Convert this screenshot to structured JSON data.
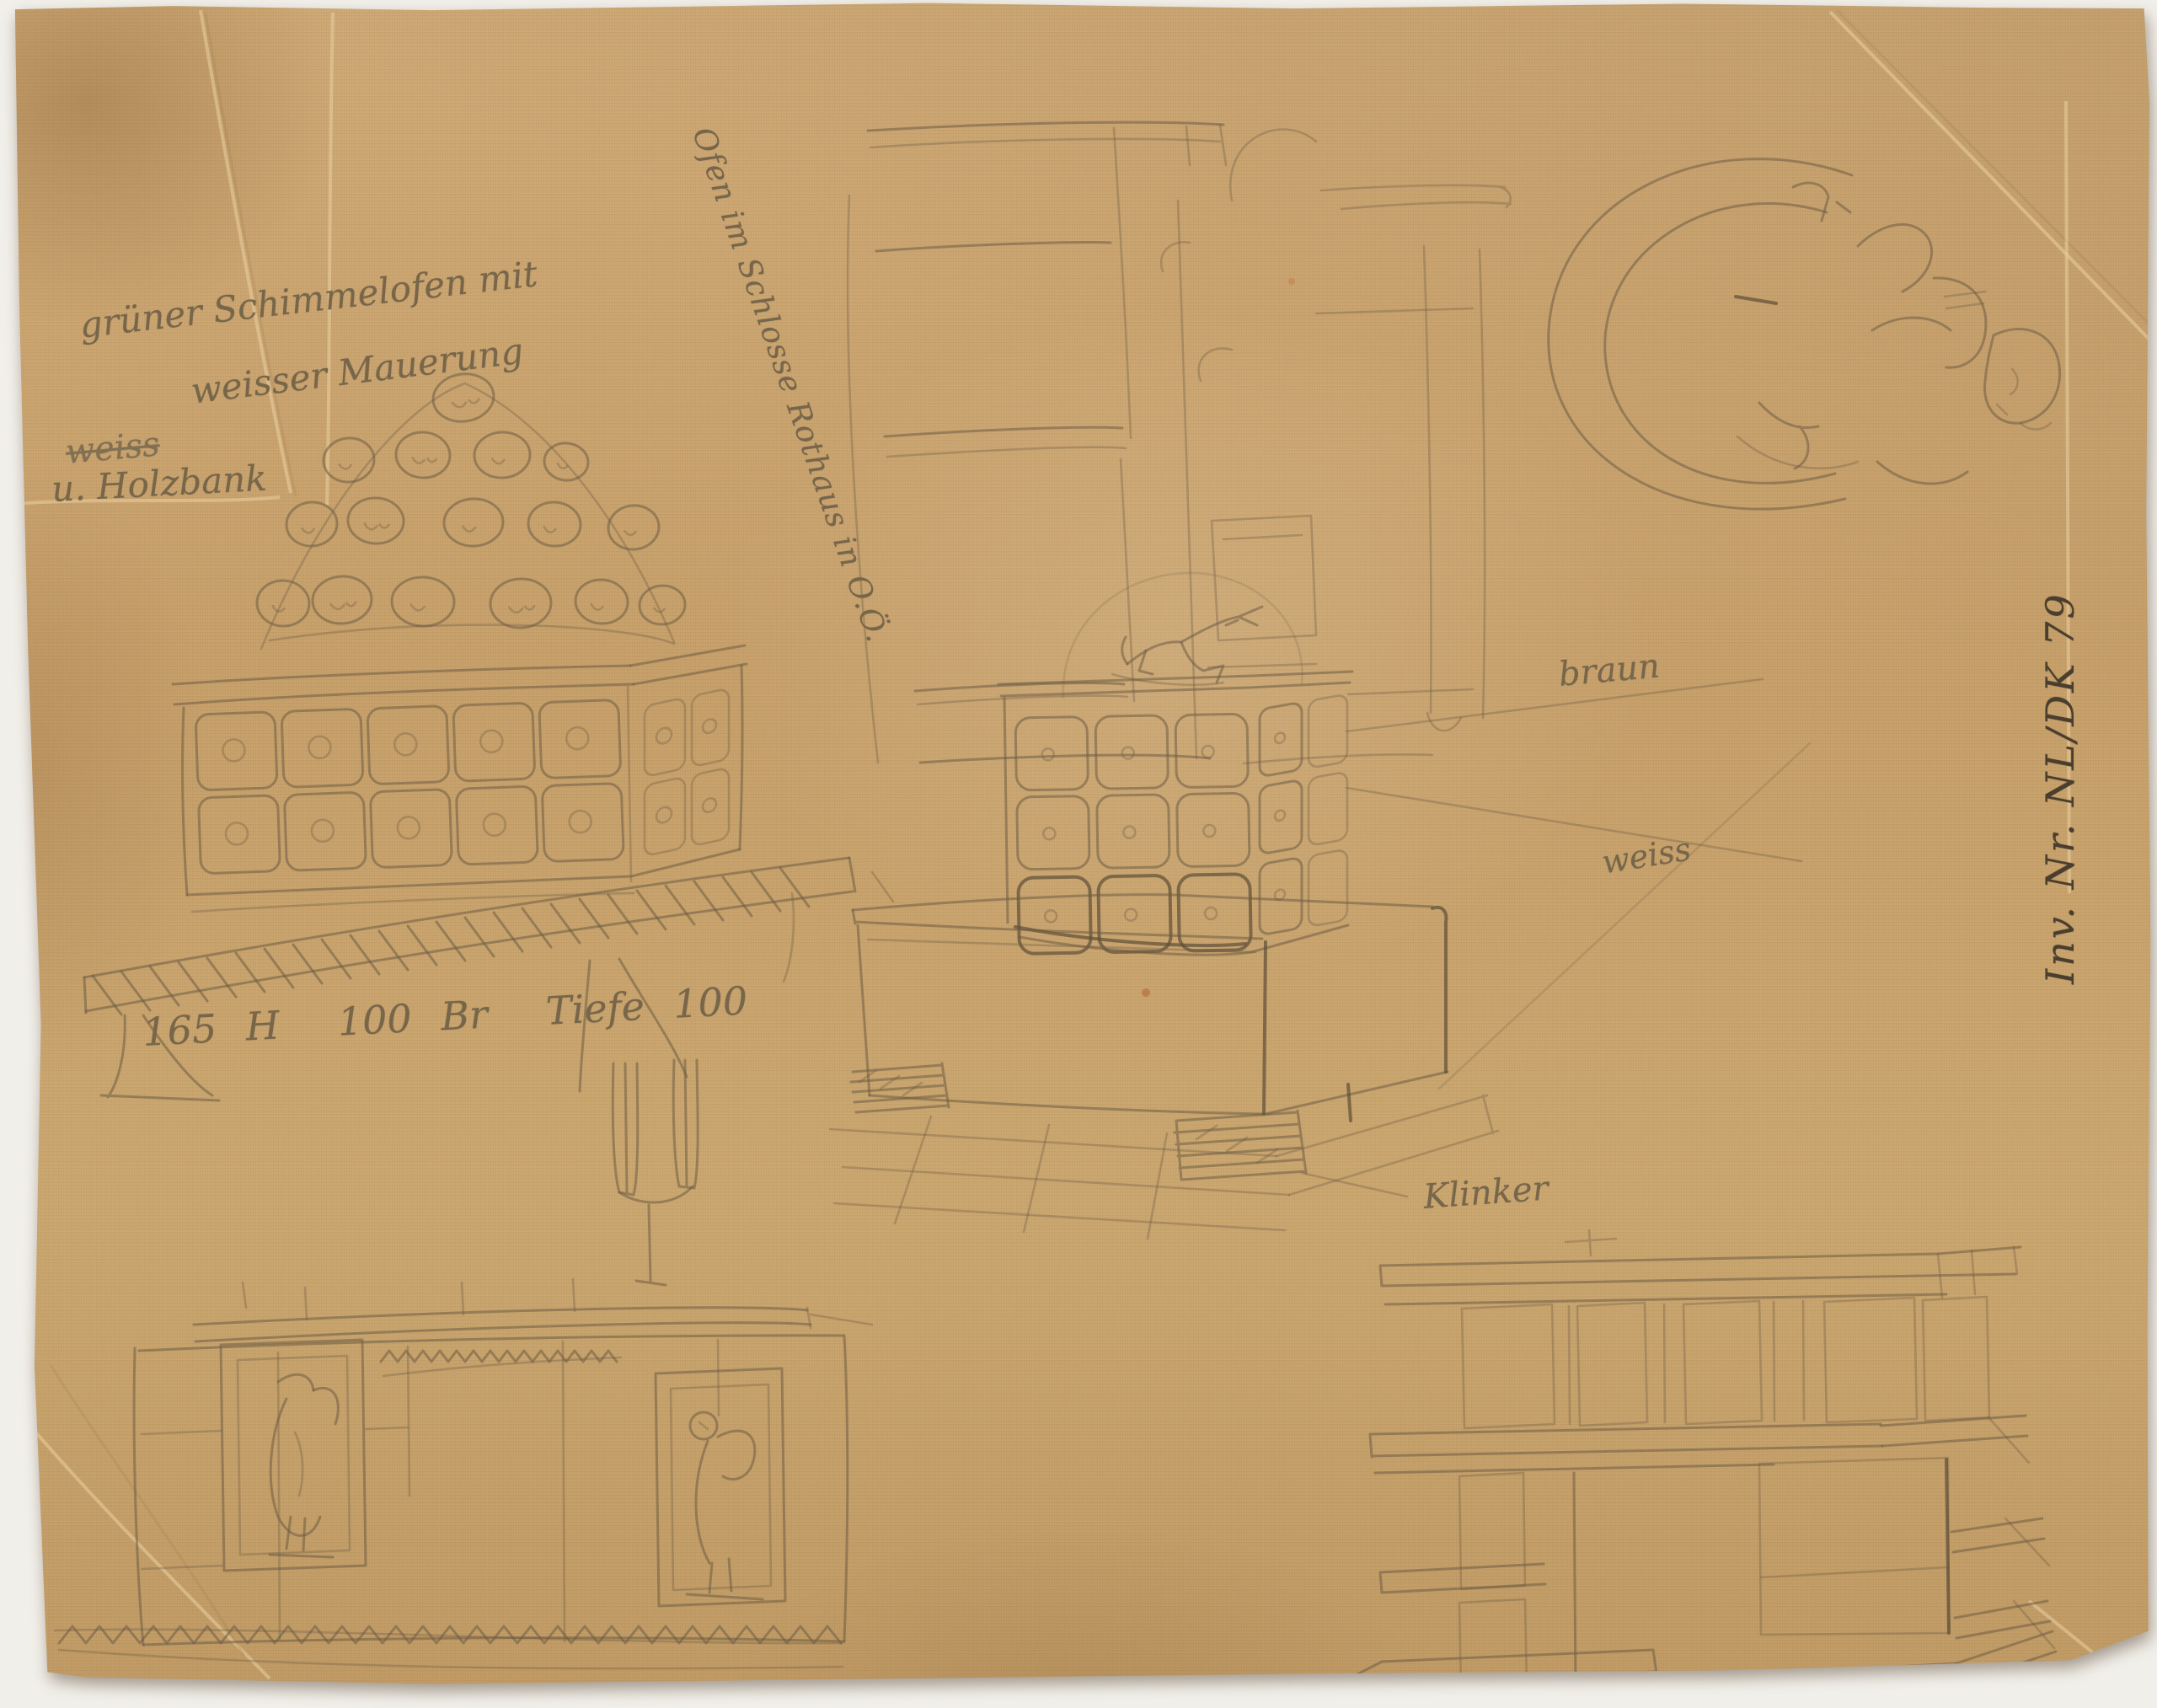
{
  "scan": {
    "background_color": "#f1efe9",
    "paper_color": "#c9a471",
    "pencil_color": "#6d5c44",
    "dark_pencil_color": "#4a3e2e",
    "stain_color": "#b5632f"
  },
  "annotations": {
    "title_block": {
      "line1": "grüner Schimmelofen mit",
      "line2": "weisser Mauerung",
      "struck_word": "weiss",
      "line3": "u. Holzbank"
    },
    "diagonal_caption": "Ofen im Schlosse Rothaus in O.Ö.",
    "dimensions": "165 H  100 Br  Tiefe 100",
    "color_note_brown": "braun",
    "color_note_white": "weiss",
    "material_note": "Klinker",
    "inventory_number": "Inv. Nr. NL/DK 79"
  }
}
